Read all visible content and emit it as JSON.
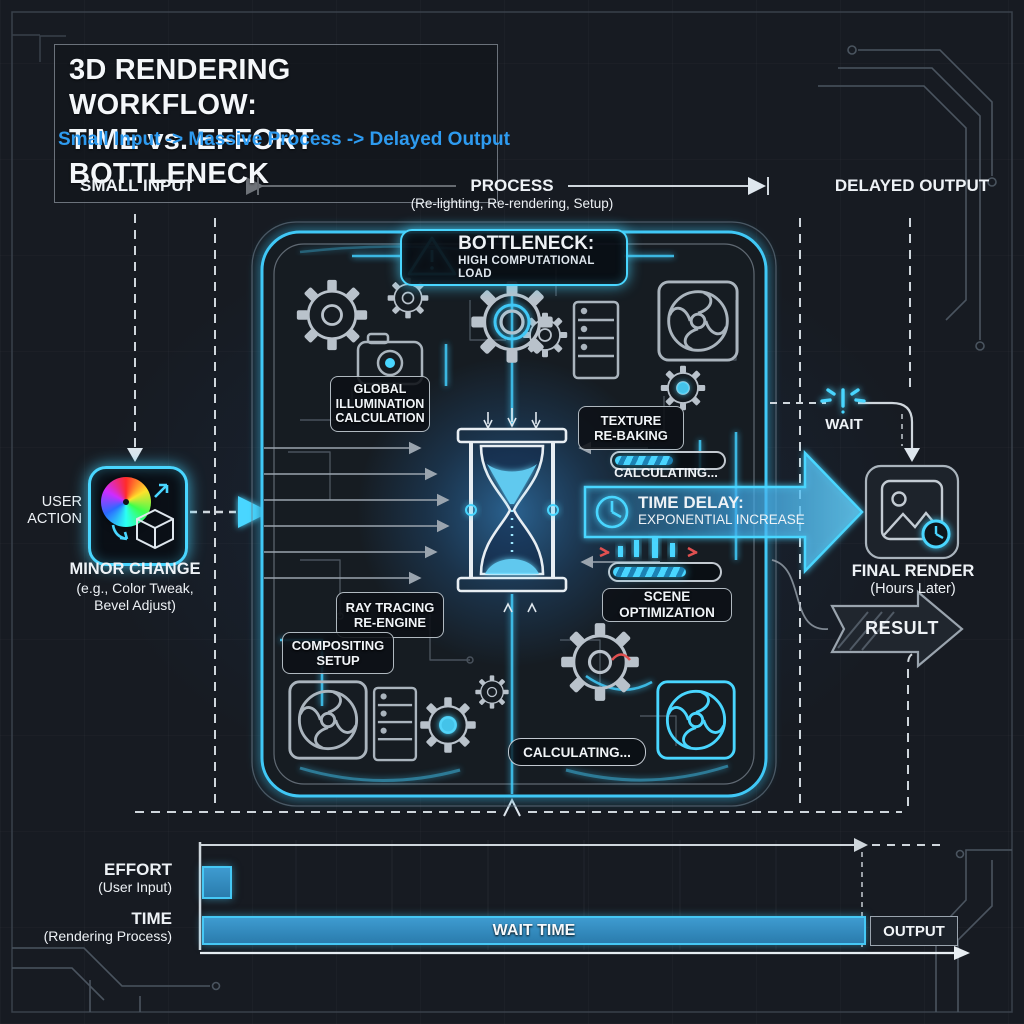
{
  "title": {
    "line1": "3D RENDERING WORKFLOW:",
    "line2": "TIME vs. EFFORT BOTTLENECK",
    "subtitle": "Small Input -> Massive Process -> Delayed Output"
  },
  "lanes": {
    "input": "SMALL INPUT",
    "process": "PROCESS",
    "process_sub": "(Re-lighting, Re-rendering, Setup)",
    "output": "DELAYED OUTPUT"
  },
  "bottleneck": {
    "label": "BOTTLENECK:",
    "sublabel": "HIGH COMPUTATIONAL LOAD"
  },
  "user_action": {
    "label_line1": "USER",
    "label_line2": "ACTION",
    "title": "MINOR CHANGE",
    "sub_line1": "(e.g., Color Tweak,",
    "sub_line2": "Bevel Adjust)"
  },
  "process_nodes": {
    "global_illumination": {
      "line1": "GLOBAL",
      "line2": "ILLUMINATION",
      "line3": "CALCULATION"
    },
    "texture": {
      "line1": "TEXTURE",
      "line2": "RE-BAKING"
    },
    "calculating_top": "CALCULATING...",
    "time_delay": {
      "label": "TIME DELAY:",
      "sublabel": "EXPONENTIAL INCREASE"
    },
    "ray_tracing": {
      "line1": "RAY TRACING",
      "line2": "RE-ENGINE"
    },
    "scene_optimization": "SCENE OPTIMIZATION",
    "compositing": {
      "line1": "COMPOSITING",
      "line2": "SETUP"
    },
    "calculating_bottom": "CALCULATING..."
  },
  "output_side": {
    "wait": "WAIT",
    "final_title": "FINAL RENDER",
    "final_sub": "(Hours Later)",
    "result": "RESULT"
  },
  "chart_data": {
    "type": "bar",
    "orientation": "horizontal",
    "categories": [
      "EFFORT",
      "TIME"
    ],
    "category_subs": [
      "(User Input)",
      "(Rendering Process)"
    ],
    "values_relative": [
      0.04,
      1.0
    ],
    "bar_annotations": [
      "",
      "WAIT TIME"
    ],
    "end_annotation": "OUTPUT",
    "axis": "time",
    "labels": {
      "effort": "EFFORT",
      "effort_sub": "(User Input)",
      "time": "TIME",
      "time_sub": "(Rendering Process)",
      "wait_bar": "WAIT TIME",
      "output_box": "OUTPUT"
    }
  },
  "colors": {
    "accent": "#49d6ff",
    "subtitle_blue": "#2e9bf0",
    "bar_fill": "#2e86c1",
    "warn_red": "#e05050"
  }
}
